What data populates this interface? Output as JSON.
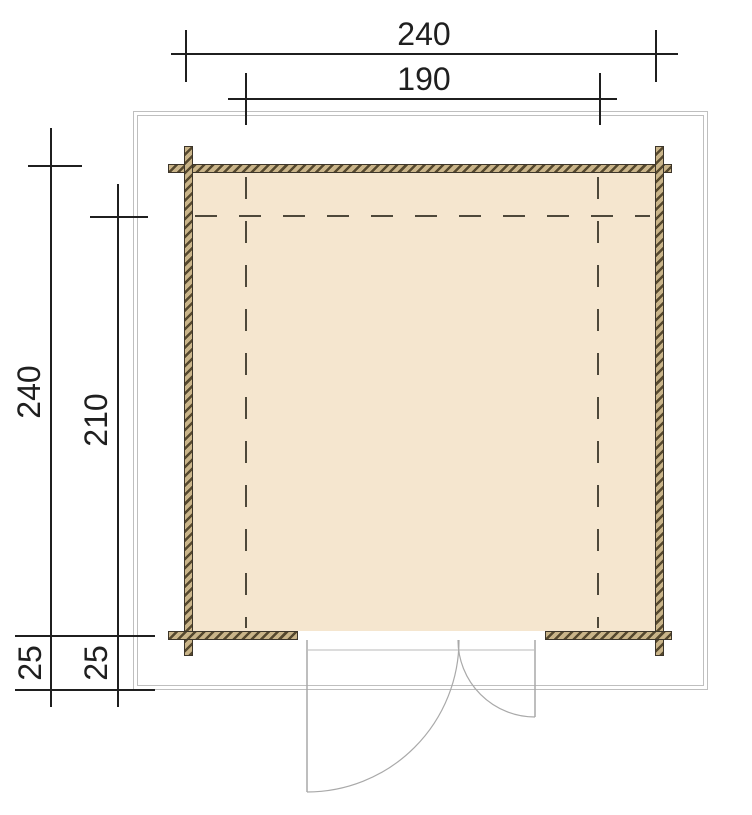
{
  "title": "Cabin floor plan",
  "dimensions": {
    "top_outer": "240",
    "top_inner": "190",
    "left_outer": "240",
    "left_inner": "210",
    "left_offset_outer": "25",
    "left_offset_inner": "25"
  },
  "colors": {
    "bg": "#ffffff",
    "floor": "#f5e6cf",
    "wall-base": "#c9b489",
    "wall-hatch": "#55482e",
    "wall-border": "#3c352a",
    "dash": "#4e483a",
    "dim": "#1f1f1f",
    "overhang": "#bfbfbf",
    "door": "#a9a9a9",
    "threshold": "#dcdcdc"
  }
}
